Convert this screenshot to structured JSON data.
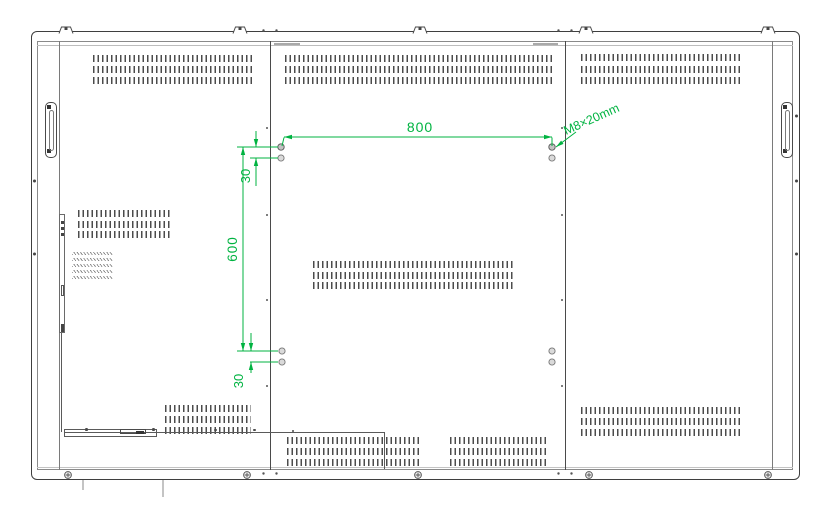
{
  "drawing": {
    "kind": "rear-panel-mounting-drawing",
    "colors": {
      "dimension_green": "#00b341",
      "outline_dark": "#3f3f3f"
    },
    "dims": {
      "w800": "800",
      "h600": "600",
      "t30": "30",
      "b30": "30",
      "screw": "M8×20mm"
    }
  }
}
